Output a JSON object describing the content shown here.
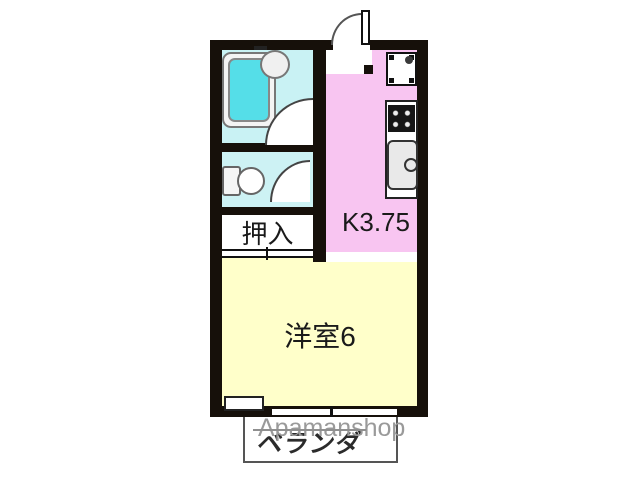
{
  "floor_plan": {
    "type": "apartment-madori",
    "rooms": {
      "kitchen": {
        "label": "K3.75",
        "color": "#f8c5f1"
      },
      "closet": {
        "label": "押入",
        "color": "#ffffff"
      },
      "main_room": {
        "label": "洋室6",
        "color": "#ffffca"
      },
      "balcony": {
        "label": "ベランダ",
        "color": "#ffffff"
      },
      "bathroom": {
        "color": "#c9f2f4"
      },
      "toilet": {
        "color": "#cdf2f4"
      }
    },
    "fixtures": [
      "bathtub",
      "wash-basin",
      "toilet",
      "entry-door",
      "washing-machine-pan",
      "stove",
      "kitchen-sink",
      "kitchen-counter",
      "balcony-window"
    ],
    "colors": {
      "wall": "#16100a",
      "bathtub_water": "#55dee8",
      "watermark_gray": "#9a9a9a"
    },
    "watermark": {
      "text": "Apamanshop"
    }
  }
}
